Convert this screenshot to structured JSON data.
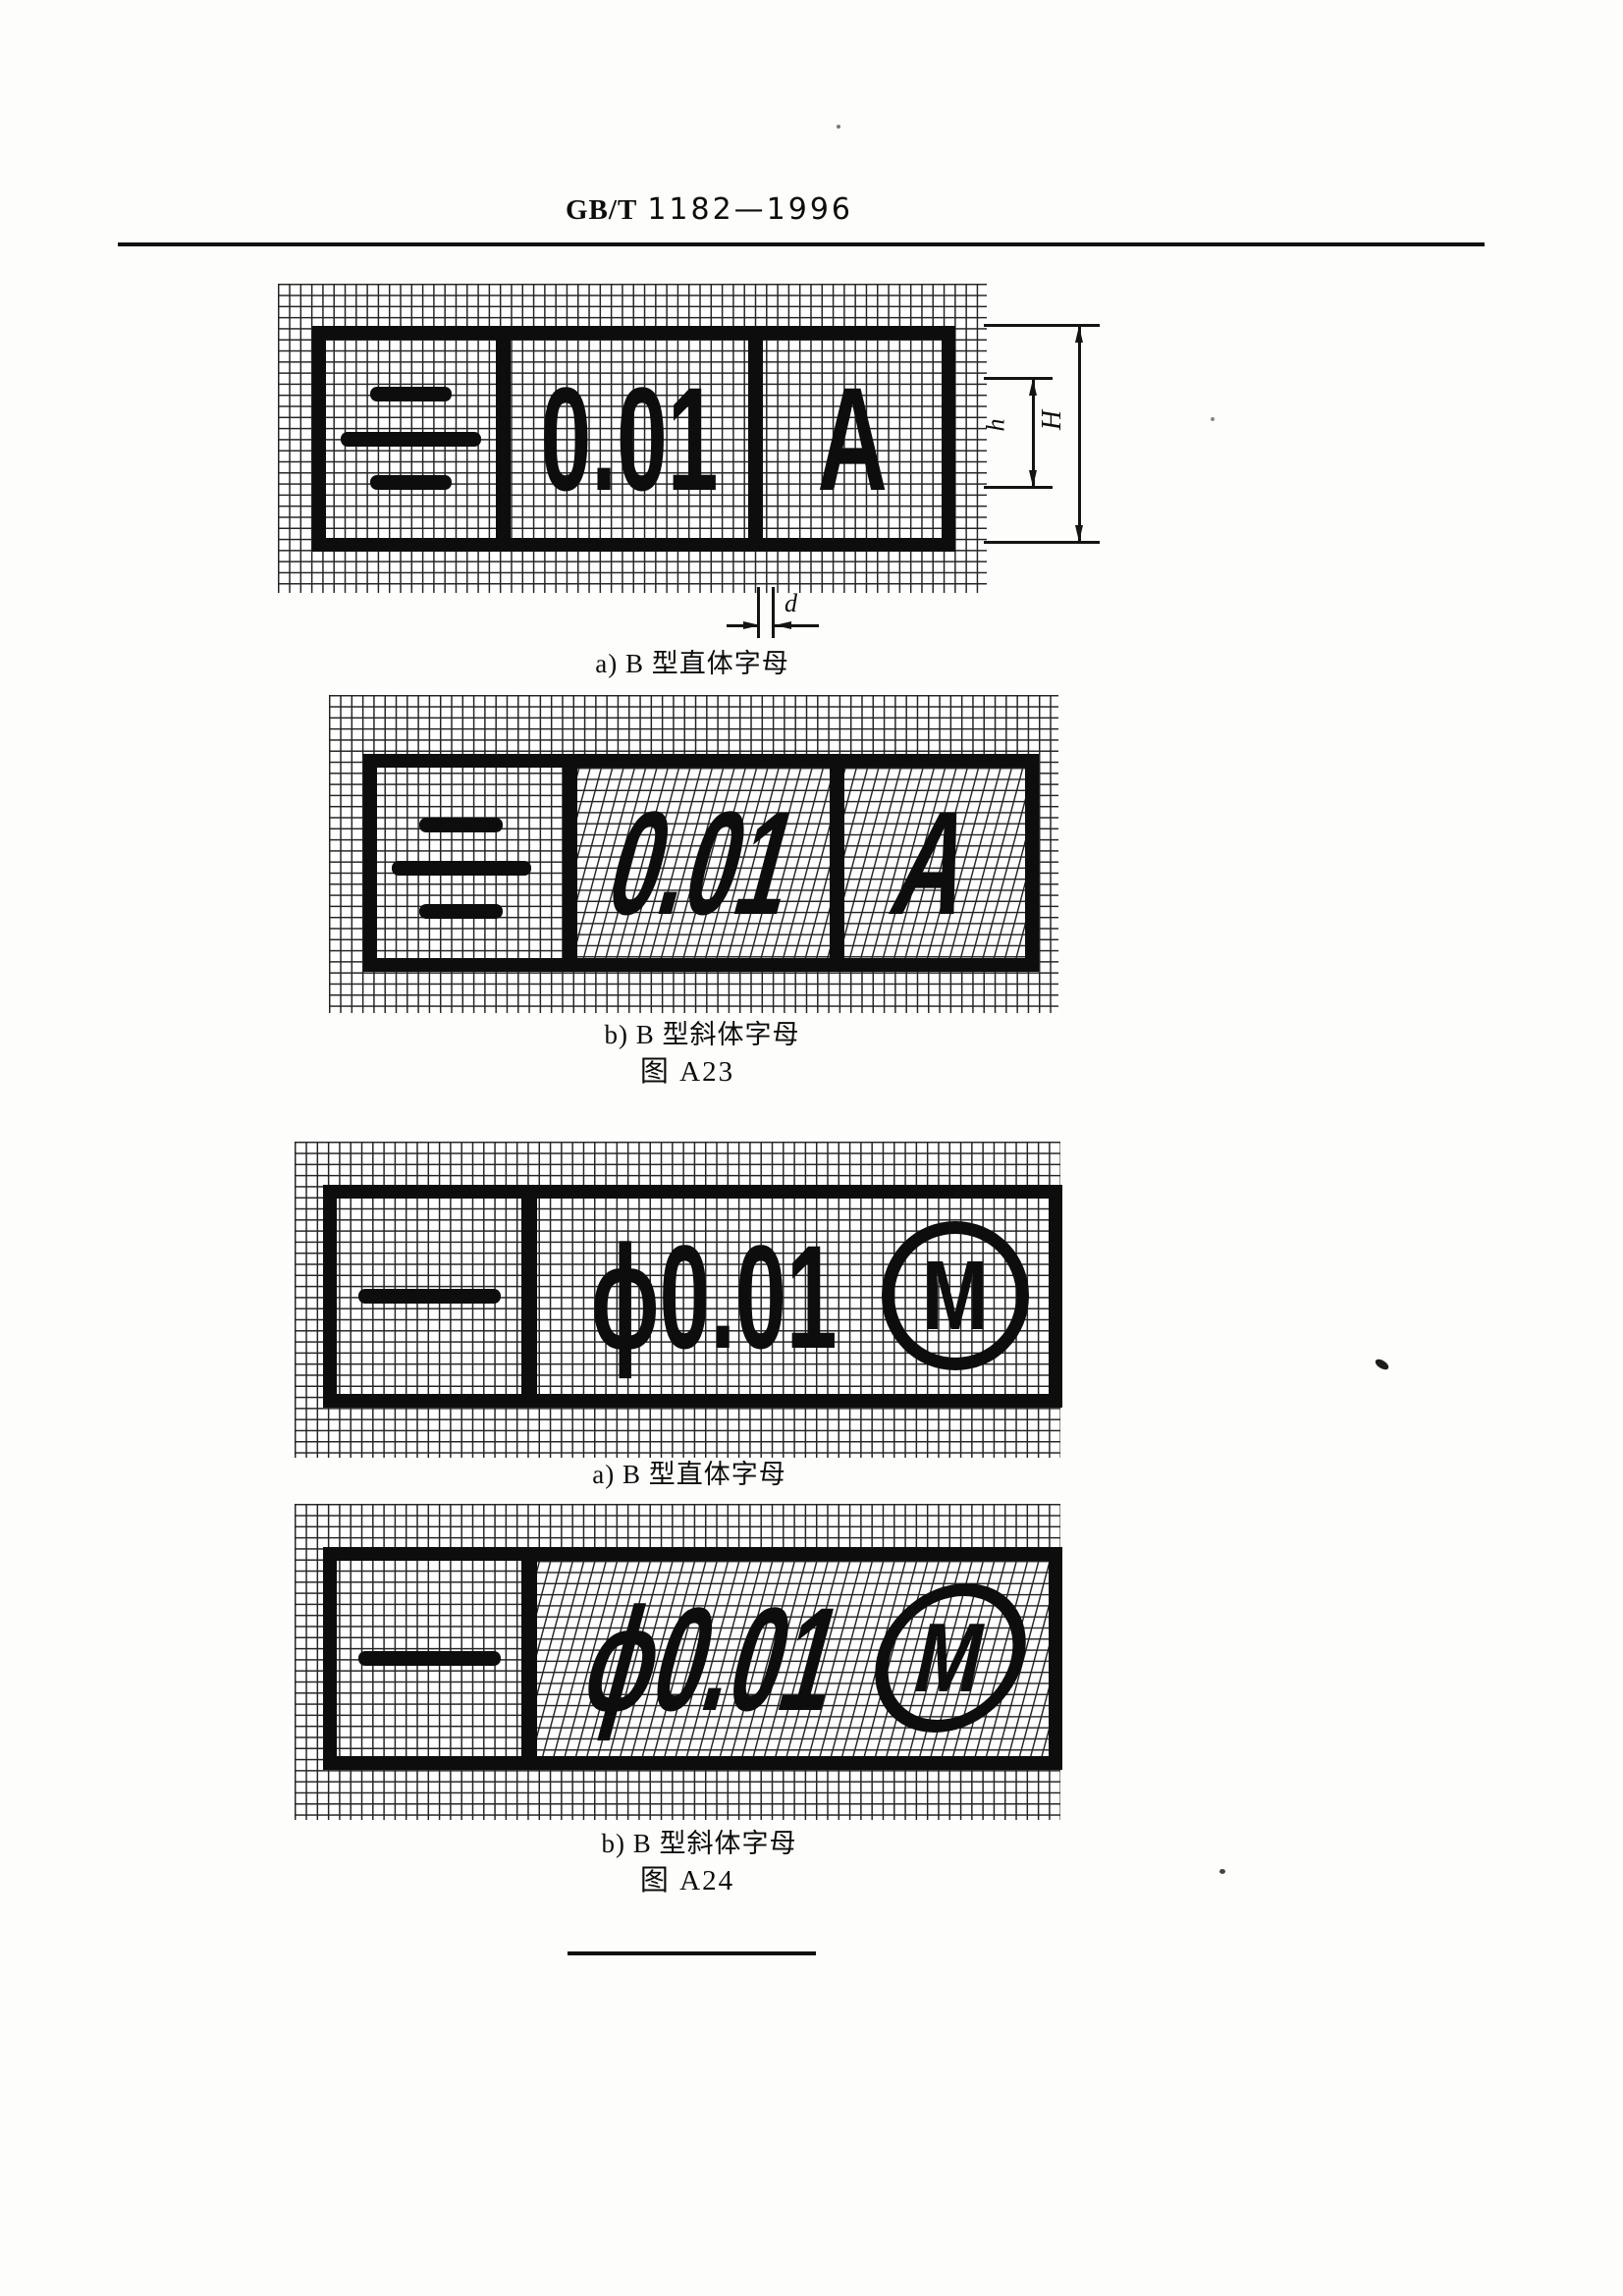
{
  "header": {
    "code_prefix": "GB/T",
    "code_number": "1182—1996"
  },
  "figure_a23": {
    "label": "图 A23",
    "upright_caption": "a) B 型直体字母",
    "italic_caption": "b) B 型斜体字母",
    "frame": {
      "symbol_name": "symmetry-symbol",
      "tolerance_value": "0.01",
      "datum_letter": "A"
    }
  },
  "figure_a24": {
    "label": "图 A24",
    "upright_caption": "a) B 型直体字母",
    "italic_caption": "b) B 型斜体字母",
    "frame": {
      "symbol_name": "straightness-symbol",
      "tolerance_value": "ϕ0.01",
      "material_modifier": "M"
    }
  },
  "dimension_labels": {
    "letter_height": "h",
    "frame_height": "H",
    "line_thickness": "d"
  },
  "colors": {
    "ink": "#0d0d0d",
    "paper": "#fdfdfb"
  }
}
